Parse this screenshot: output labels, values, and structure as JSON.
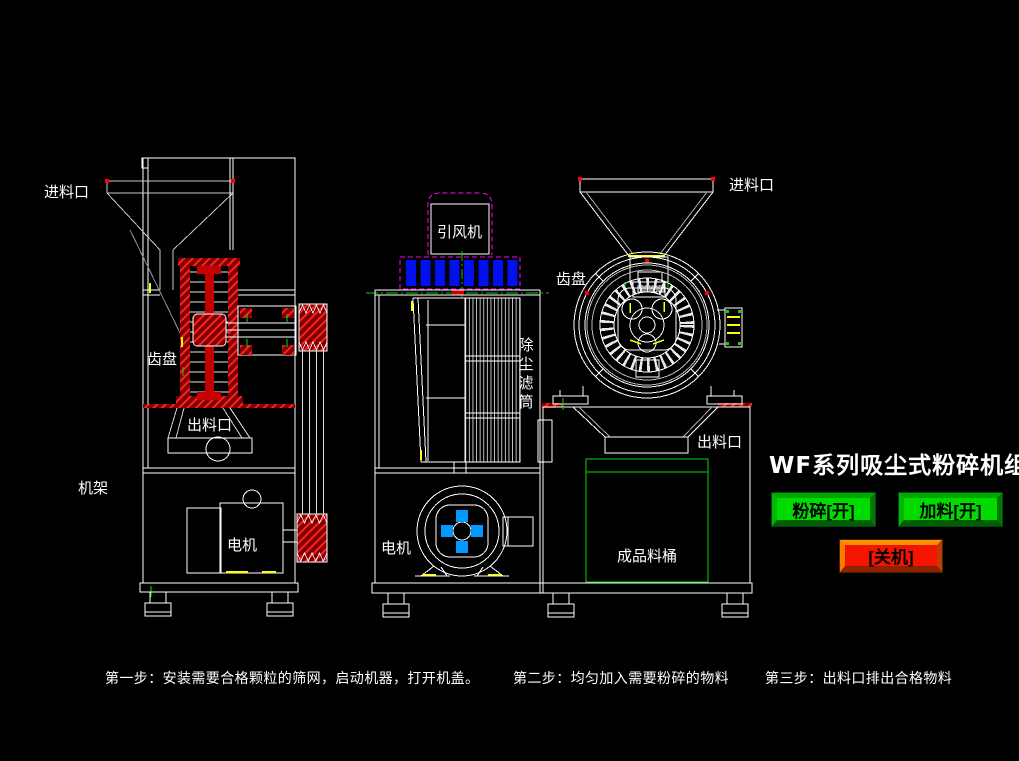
{
  "app": {
    "background": "#000000",
    "width": 1019,
    "height": 761
  },
  "diagram_title": "WF系列吸尘式粉碎机组",
  "control_panel": {
    "buttons": [
      {
        "id": "crush-on",
        "label": "粉碎[开]",
        "color": "#00dc00"
      },
      {
        "id": "feed-on",
        "label": "加料[开]",
        "color": "#00dc00"
      },
      {
        "id": "shutdown",
        "label": "[关机]",
        "color": "#f51400"
      }
    ]
  },
  "machine_labels": {
    "left_view": {
      "inlet": "进料口",
      "gear_disc": "齿盘",
      "outlet": "出料口",
      "frame": "机架",
      "motor": "电机"
    },
    "middle_view": {
      "draft_fan": "引风机",
      "dust_filter": "除尘滤筒",
      "motor": "电机"
    },
    "right_view": {
      "inlet": "进料口",
      "gear_disc": "齿盘",
      "outlet": "出料口",
      "product_barrel": "成品料桶"
    }
  },
  "instructions": [
    {
      "text": "第一步：安装需要合格颗粒的筛网，启动机器，打开机盖。"
    },
    {
      "text": "第二步：均匀加入需要粉碎的物料"
    },
    {
      "text": "第三步：出料口排出合格物料"
    }
  ],
  "colors": {
    "line_white": "#ffffff",
    "section_red": "#cc0000",
    "magenta_dashed": "#ff00ff",
    "fan_grille_blue": "#0011ee",
    "motor_blade_blue": "#0099ff",
    "barrel_green": "#00dd00",
    "marker_yellow": "#ffff00",
    "marker_green": "#00cc00"
  }
}
